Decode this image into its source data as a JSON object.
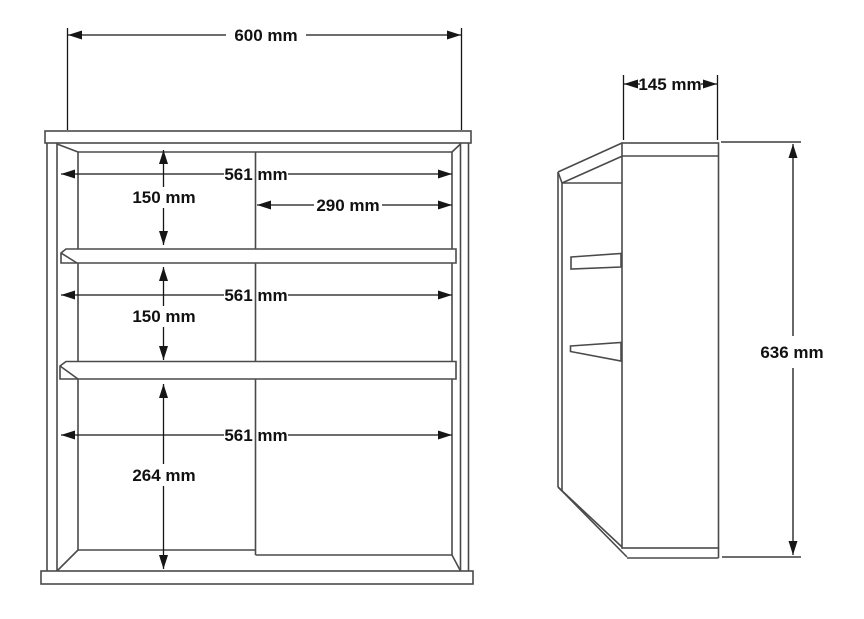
{
  "drawing": {
    "type": "furniture-dimension-drawing",
    "unit": "mm",
    "front_view": {
      "overall_width_label": "600 mm",
      "interior_width_top_label": "561 mm",
      "interior_width_middle_label": "561 mm",
      "interior_width_bottom_label": "561 mm",
      "door_width_label": "290 mm",
      "top_section_height_label": "150 mm",
      "middle_section_height_label": "150 mm",
      "bottom_section_height_label": "264 mm"
    },
    "side_view": {
      "depth_label": "145 mm",
      "overall_height_label": "636 mm"
    },
    "colors": {
      "background": "#ffffff",
      "structure_line": "#4a4a4a",
      "dimension_line": "#161616",
      "text": "#111111"
    }
  }
}
